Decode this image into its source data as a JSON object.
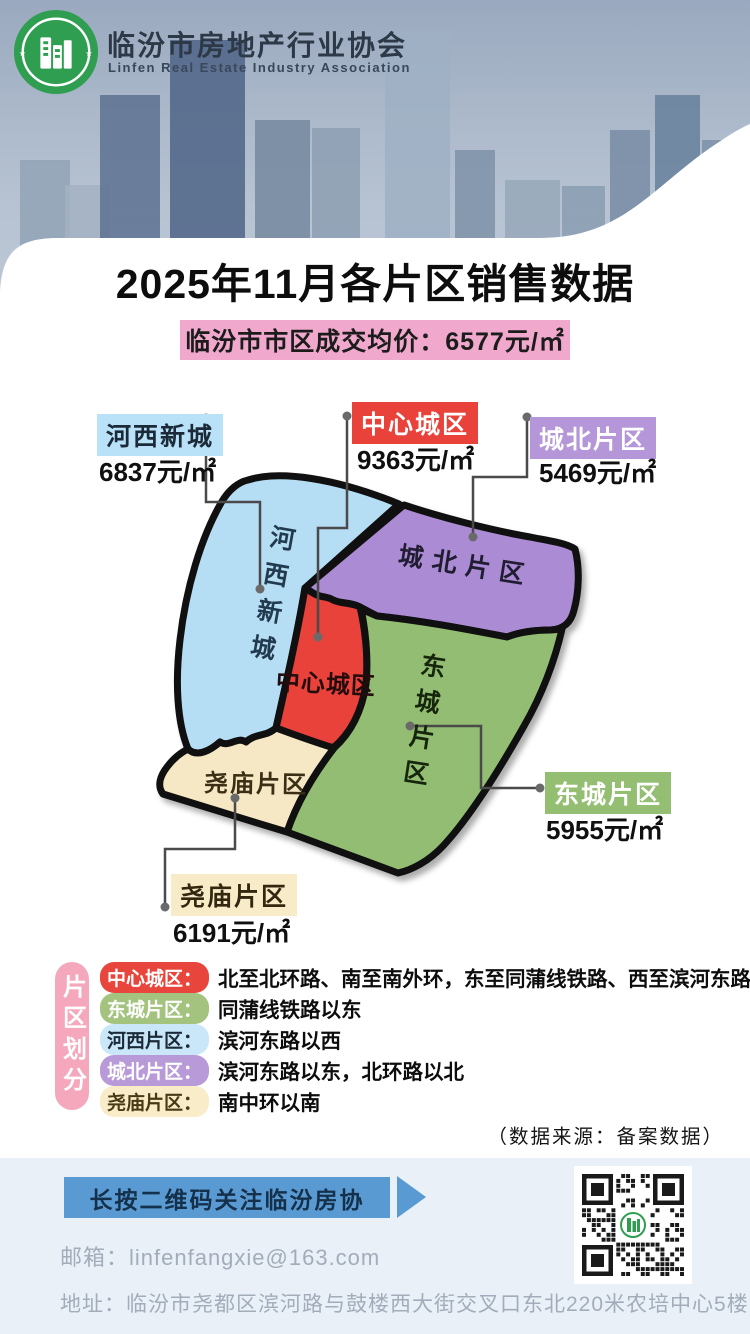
{
  "header": {
    "org_cn": "临汾市房地产行业协会",
    "org_en": "Linfen Real Estate Industry Association"
  },
  "title": "2025年11月各片区销售数据",
  "avg_price_banner": "临汾市市区成交均价：6577元/㎡",
  "map": {
    "districts": [
      {
        "id": "hexi",
        "name": "河西新城",
        "price": "6837元/㎡"
      },
      {
        "id": "center",
        "name": "中心城区",
        "price": "9363元/㎡"
      },
      {
        "id": "chengbei",
        "name": "城北片区",
        "price": "5469元/㎡"
      },
      {
        "id": "dongcheng",
        "name": "东城片区",
        "price": "5955元/㎡"
      },
      {
        "id": "yaomiao",
        "name": "尧庙片区",
        "price": "6191元/㎡"
      }
    ]
  },
  "legend": {
    "side_label": "片区划分",
    "items": [
      {
        "name": "中心城区：",
        "desc": "北至北环路、南至南外环，东至同蒲线铁路、西至滨河东路"
      },
      {
        "name": "东城片区：",
        "desc": "同蒲线铁路以东"
      },
      {
        "name": "河西片区：",
        "desc": "滨河东路以西"
      },
      {
        "name": "城北片区：",
        "desc": "滨河东路以东，北环路以北"
      },
      {
        "name": "尧庙片区：",
        "desc": "南中环以南"
      }
    ]
  },
  "source_note": "（数据来源：备案数据）",
  "footer": {
    "qr_button": "长按二维码关注临汾房协",
    "email": "邮箱：linfenfangxie@163.com",
    "address": "地址：临汾市尧都区滨河路与鼓楼西大街交叉口东北220米农培中心5楼"
  },
  "colors": {
    "center_red": "#e8423a",
    "chengbei_purple": "#b596d8",
    "hexi_blue": "#b5ddf4",
    "dongcheng_green": "#93bd72",
    "yaomiao_cream": "#f6e8c4",
    "banner_pink": "#f0a9cd",
    "button_blue": "#5a9ad3"
  }
}
